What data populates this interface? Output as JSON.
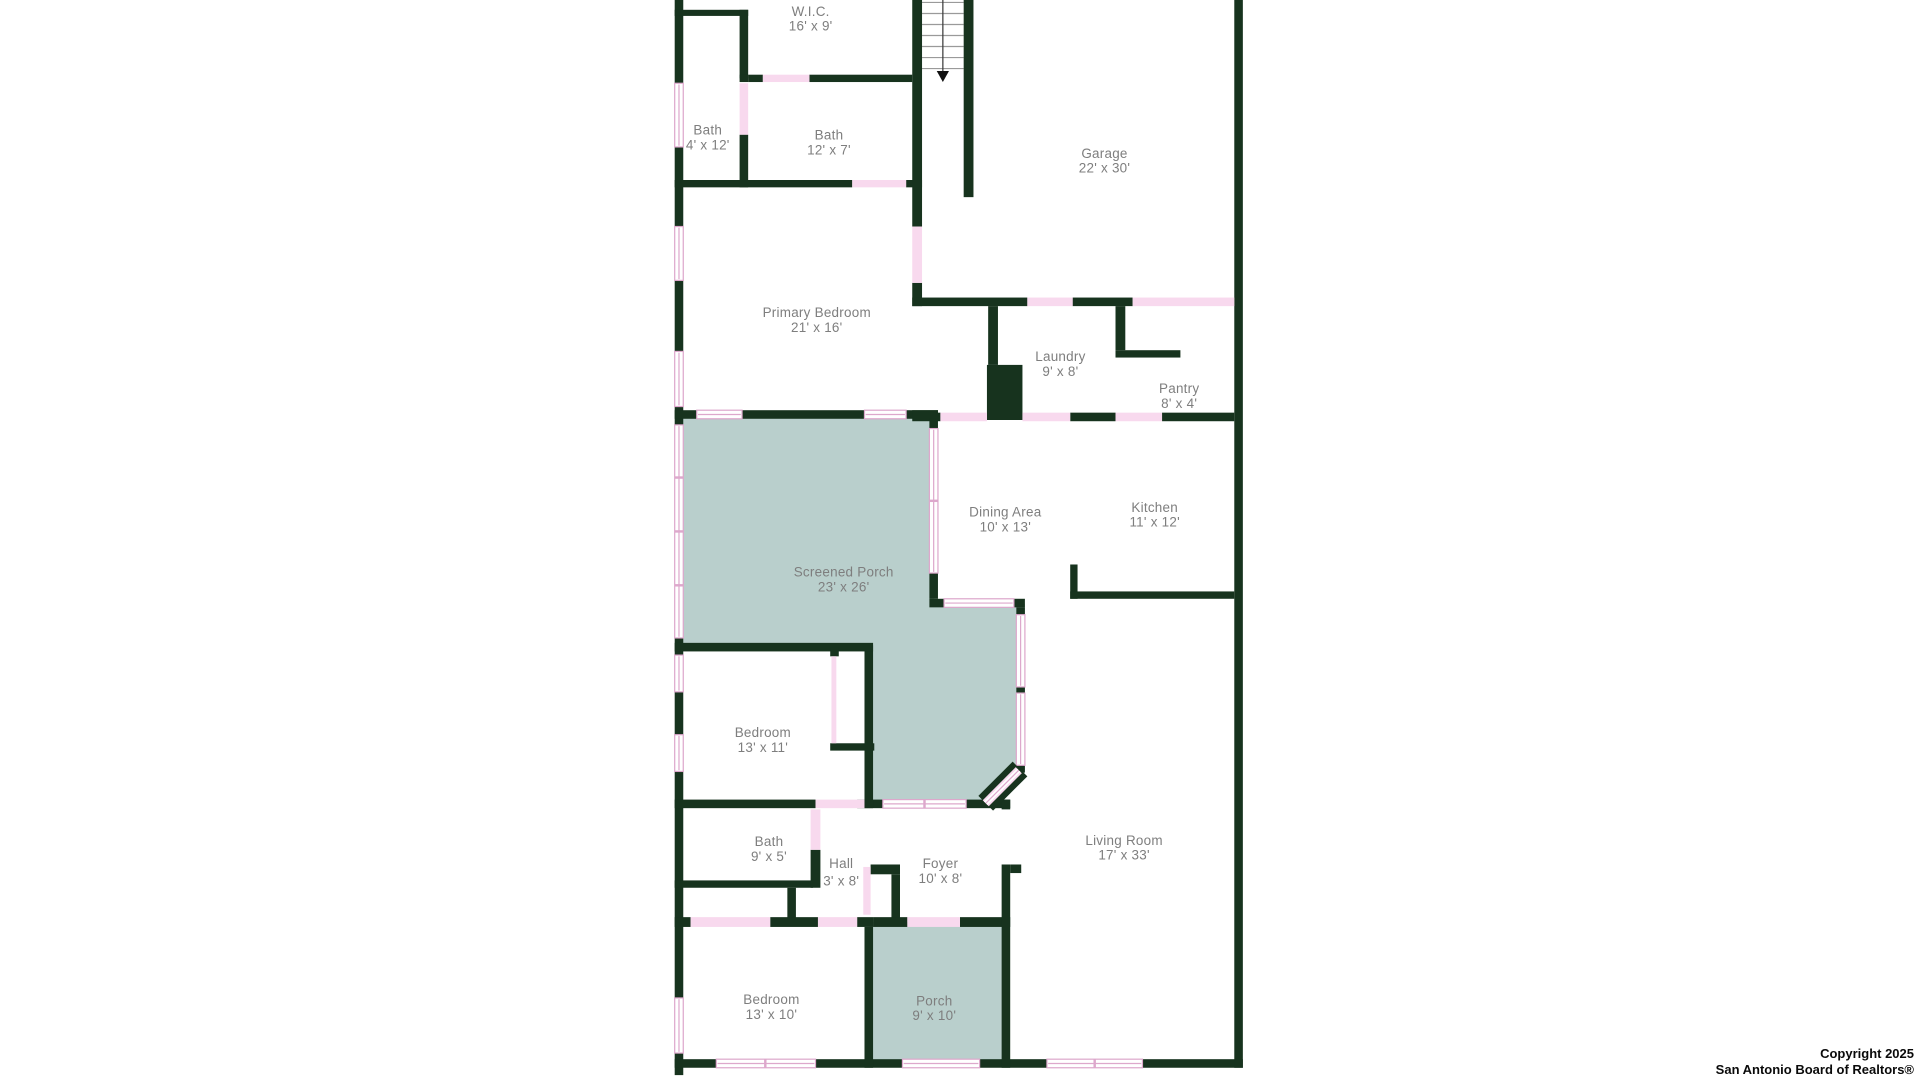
{
  "page": {
    "title": "Residential floor plan"
  },
  "colors": {
    "wall": "#17331e",
    "door": "#f8d9ee",
    "window_stroke": "#dda8cc",
    "porch_fill": "#b9cfcc",
    "label": "#7e7e7e",
    "background": "#ffffff"
  },
  "rooms": [
    {
      "name": "W.I.C.",
      "dims": "16' x 9'"
    },
    {
      "name": "Bath",
      "dims": "4' x 12'"
    },
    {
      "name": "Bath",
      "dims": "12' x 7'"
    },
    {
      "name": "Garage",
      "dims": "22' x 30'"
    },
    {
      "name": "Primary Bedroom",
      "dims": "21' x 16'"
    },
    {
      "name": "Laundry",
      "dims": "9' x 8'"
    },
    {
      "name": "Pantry",
      "dims": "8' x 4'"
    },
    {
      "name": "Dining Area",
      "dims": "10' x 13'"
    },
    {
      "name": "Kitchen",
      "dims": "11' x 12'"
    },
    {
      "name": "Screened Porch",
      "dims": "23' x 26'"
    },
    {
      "name": "Bedroom",
      "dims": "13' x 11'"
    },
    {
      "name": "Living Room",
      "dims": "17' x 33'"
    },
    {
      "name": "Bath",
      "dims": "9' x 5'"
    },
    {
      "name": "Hall",
      "dims": "3' x 8'"
    },
    {
      "name": "Foyer",
      "dims": "10' x 8'"
    },
    {
      "name": "Bedroom",
      "dims": "13' x 10'"
    },
    {
      "name": "Porch",
      "dims": "9' x 10'"
    }
  ],
  "stairs": {
    "treads": 7,
    "direction_arrow": "down"
  },
  "copyright": {
    "line1": "Copyright 2025",
    "line2": "San Antonio Board of Realtors®"
  }
}
